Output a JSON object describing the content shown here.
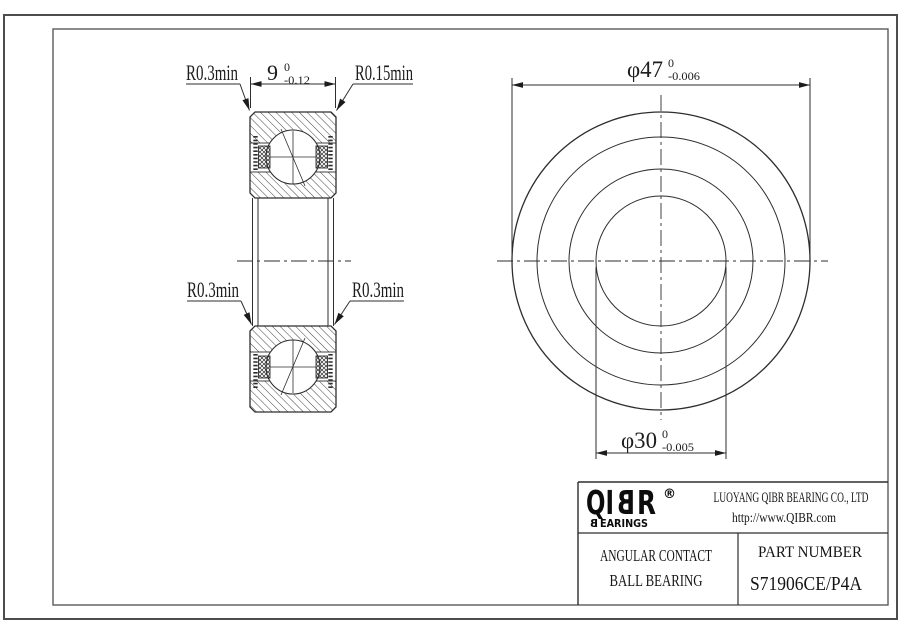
{
  "section_view": {
    "width_dim": {
      "value": "9",
      "tol_upper": "0",
      "tol_lower": "-0.12"
    },
    "label_top_left": "R0.3min",
    "label_top_right": "R0.15min",
    "label_mid_left": "R0.3min",
    "label_mid_right": "R0.3min"
  },
  "front_view": {
    "outer_dim": {
      "value": "φ47",
      "tol_upper": "0",
      "tol_lower": "-0.006"
    },
    "bore_dim": {
      "value": "φ30",
      "tol_upper": "0",
      "tol_lower": "-0.005"
    }
  },
  "title_block": {
    "logo": {
      "part1": "QI",
      "mirrored": "B",
      "part2": "R",
      "registered": "®",
      "tagline_first": "B",
      "tagline_rest": "EARINGS"
    },
    "company": "LUOYANG QIBR BEARING CO., LTD",
    "website": "http://www.QIBR.com",
    "product": {
      "line1": "ANGULAR CONTACT",
      "line2": "BALL BEARING"
    },
    "part_number_label": "PART NUMBER",
    "part_number": "S71906CE/P4A"
  },
  "colors": {
    "line": "#2e2e2e",
    "background": "#ffffff"
  }
}
